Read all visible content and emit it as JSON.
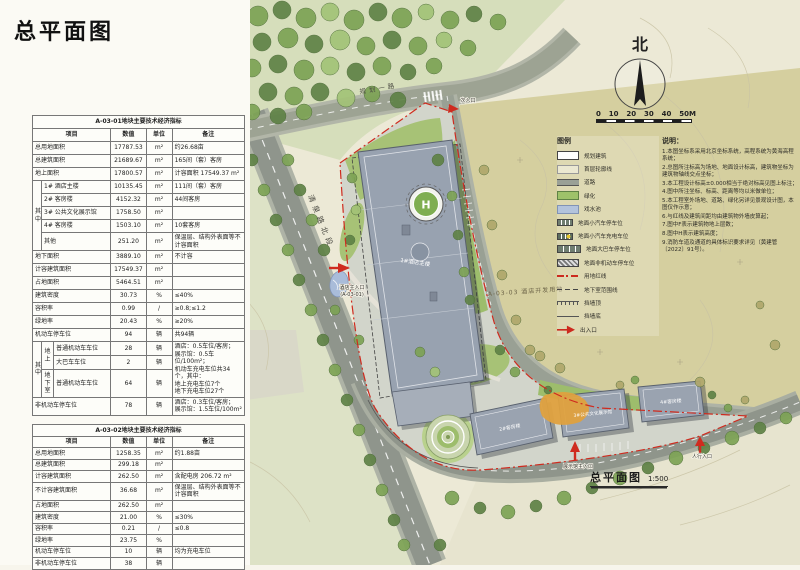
{
  "page": {
    "title": "总平面图"
  },
  "table1": {
    "title": "A-03-01地块主要技术经济指标",
    "header": [
      {
        "t": "项目",
        "cs": 3
      },
      {
        "t": "数值"
      },
      {
        "t": "单位"
      },
      {
        "t": "备注"
      }
    ],
    "rows": [
      [
        {
          "t": "总用地面积",
          "cs": 3,
          "cls": "item"
        },
        {
          "t": "17787.53",
          "cls": "num"
        },
        {
          "t": "m²",
          "cls": "unit"
        },
        {
          "t": "约26.68亩",
          "cls": "rem"
        }
      ],
      [
        {
          "t": "总建筑面积",
          "cs": 3,
          "cls": "item"
        },
        {
          "t": "21689.67",
          "cls": "num"
        },
        {
          "t": "m²",
          "cls": "unit"
        },
        {
          "t": "165间（套）客房",
          "cls": "rem"
        }
      ],
      [
        {
          "t": "地上面积",
          "cs": 3,
          "cls": "item ind1"
        },
        {
          "t": "17800.57",
          "cls": "num"
        },
        {
          "t": "m²",
          "cls": "unit"
        },
        {
          "t": "计容面积 17549.37 m²",
          "cls": "rem"
        }
      ],
      [
        {
          "t": "其中",
          "rs": 5,
          "cls": "vert"
        },
        {
          "t": "1# 酒店主楼",
          "cs": 2,
          "cls": "item ind2"
        },
        {
          "t": "10135.45",
          "cls": "num"
        },
        {
          "t": "m²",
          "cls": "unit"
        },
        {
          "t": "111间（套）客房",
          "cls": "rem"
        }
      ],
      [
        {
          "t": "2# 客房楼",
          "cs": 2,
          "cls": "item ind2"
        },
        {
          "t": "4152.32",
          "cls": "num"
        },
        {
          "t": "m²",
          "cls": "unit"
        },
        {
          "t": "44间客房",
          "cls": "rem"
        }
      ],
      [
        {
          "t": "3# 公共文化展示馆",
          "cs": 2,
          "cls": "item ind2"
        },
        {
          "t": "1758.50",
          "cls": "num"
        },
        {
          "t": "m²",
          "cls": "unit"
        },
        {
          "t": "",
          "cls": "rem"
        }
      ],
      [
        {
          "t": "4# 客房楼",
          "cs": 2,
          "cls": "item ind2"
        },
        {
          "t": "1503.10",
          "cls": "num"
        },
        {
          "t": "m²",
          "cls": "unit"
        },
        {
          "t": "10套客房",
          "cls": "rem"
        }
      ],
      [
        {
          "t": "其他",
          "cs": 2,
          "cls": "item ind2"
        },
        {
          "t": "251.20",
          "cls": "num"
        },
        {
          "t": "m²",
          "cls": "unit"
        },
        {
          "t": "保温层、结构外表面等不计容面积",
          "cls": "rem"
        }
      ],
      [
        {
          "t": "地下面积",
          "cs": 3,
          "cls": "item ind1"
        },
        {
          "t": "3889.10",
          "cls": "num"
        },
        {
          "t": "m²",
          "cls": "unit"
        },
        {
          "t": "不计容",
          "cls": "rem"
        }
      ],
      [
        {
          "t": "计容建筑面积",
          "cs": 3,
          "cls": "item"
        },
        {
          "t": "17549.37",
          "cls": "num"
        },
        {
          "t": "m²",
          "cls": "unit"
        },
        {
          "t": "",
          "cls": "rem"
        }
      ],
      [
        {
          "t": "占地面积",
          "cs": 3,
          "cls": "item ind1"
        },
        {
          "t": "5464.51",
          "cls": "num"
        },
        {
          "t": "m²",
          "cls": "unit"
        },
        {
          "t": "",
          "cls": "rem"
        }
      ],
      [
        {
          "t": "建筑密度",
          "cs": 3,
          "cls": "item ind1"
        },
        {
          "t": "30.73",
          "cls": "num"
        },
        {
          "t": "%",
          "cls": "unit"
        },
        {
          "t": "≤40%",
          "cls": "rem"
        }
      ],
      [
        {
          "t": "容积率",
          "cs": 3,
          "cls": "item ind1"
        },
        {
          "t": "0.99",
          "cls": "num"
        },
        {
          "t": "/",
          "cls": "unit"
        },
        {
          "t": "≥0.8;≤1.2",
          "cls": "rem"
        }
      ],
      [
        {
          "t": "绿地率",
          "cs": 3,
          "cls": "item ind1"
        },
        {
          "t": "20.43",
          "cls": "num"
        },
        {
          "t": "%",
          "cls": "unit"
        },
        {
          "t": "≥20%",
          "cls": "rem"
        }
      ],
      [
        {
          "t": "机动车停车位",
          "cs": 3,
          "cls": "item"
        },
        {
          "t": "94",
          "cls": "num"
        },
        {
          "t": "辆",
          "cls": "unit"
        },
        {
          "t": "共94辆",
          "cls": "rem"
        }
      ],
      [
        {
          "t": "其中",
          "rs": 3,
          "cls": "vert"
        },
        {
          "t": "地上",
          "rs": 2,
          "cls": "vert"
        },
        {
          "t": "普通机动车车位",
          "cls": "item ind2"
        },
        {
          "t": "28",
          "cls": "num"
        },
        {
          "t": "辆",
          "cls": "unit"
        },
        {
          "t": "酒店：0.5车位/客房；\n展示馆：0.5车位/100m²；\n机动车充电车位共34个，其中：\n地上充电车位7个\n地下充电车位27个",
          "rs": 3,
          "cls": "rem pre"
        }
      ],
      [
        {
          "t": "大巴车车位",
          "cls": "item ind2"
        },
        {
          "t": "2",
          "cls": "num"
        },
        {
          "t": "辆",
          "cls": "unit"
        }
      ],
      [
        {
          "t": "地下室",
          "cls": "vert"
        },
        {
          "t": "普通机动车车位",
          "cls": "item ind2"
        },
        {
          "t": "64",
          "cls": "num"
        },
        {
          "t": "辆",
          "cls": "unit"
        }
      ],
      [
        {
          "t": "非机动车停车位",
          "cs": 3,
          "cls": "item"
        },
        {
          "t": "78",
          "cls": "num"
        },
        {
          "t": "辆",
          "cls": "unit"
        },
        {
          "t": "酒店：0.3车位/客房；\n展示馆：1.5车位/100m²",
          "cls": "rem pre"
        }
      ]
    ]
  },
  "table2": {
    "title": "A-03-02地块主要技术经济指标",
    "header": [
      {
        "t": "项目"
      },
      {
        "t": "数值"
      },
      {
        "t": "单位"
      },
      {
        "t": "备注"
      }
    ],
    "rows": [
      [
        {
          "t": "总用地面积",
          "cls": "item"
        },
        {
          "t": "1258.35",
          "cls": "num"
        },
        {
          "t": "m²",
          "cls": "unit"
        },
        {
          "t": "约1.88亩",
          "cls": "rem"
        }
      ],
      [
        {
          "t": "总建筑面积",
          "cls": "item"
        },
        {
          "t": "299.18",
          "cls": "num"
        },
        {
          "t": "m²",
          "cls": "unit"
        },
        {
          "t": "",
          "cls": "rem"
        }
      ],
      [
        {
          "t": "计容建筑面积",
          "cls": "item ind1"
        },
        {
          "t": "262.50",
          "cls": "num"
        },
        {
          "t": "m²",
          "cls": "unit"
        },
        {
          "t": "含配电房 206.72 m²",
          "cls": "rem"
        }
      ],
      [
        {
          "t": "不计容建筑面积",
          "cls": "item ind1"
        },
        {
          "t": "36.68",
          "cls": "num"
        },
        {
          "t": "m²",
          "cls": "unit"
        },
        {
          "t": "保温层、结构外表面等不计容面积",
          "cls": "rem"
        }
      ],
      [
        {
          "t": "占地面积",
          "cls": "item ind1"
        },
        {
          "t": "262.50",
          "cls": "num"
        },
        {
          "t": "m²",
          "cls": "unit"
        },
        {
          "t": "",
          "cls": "rem"
        }
      ],
      [
        {
          "t": "建筑密度",
          "cls": "item ind1"
        },
        {
          "t": "21.00",
          "cls": "num"
        },
        {
          "t": "%",
          "cls": "unit"
        },
        {
          "t": "≤30%",
          "cls": "rem"
        }
      ],
      [
        {
          "t": "容积率",
          "cls": "item ind1"
        },
        {
          "t": "0.21",
          "cls": "num"
        },
        {
          "t": "/",
          "cls": "unit"
        },
        {
          "t": "≤0.8",
          "cls": "rem"
        }
      ],
      [
        {
          "t": "绿地率",
          "cls": "item ind1"
        },
        {
          "t": "23.75",
          "cls": "num"
        },
        {
          "t": "%",
          "cls": "unit"
        },
        {
          "t": "",
          "cls": "rem"
        }
      ],
      [
        {
          "t": "机动车停车位",
          "cls": "item ind1"
        },
        {
          "t": "10",
          "cls": "num"
        },
        {
          "t": "辆",
          "cls": "unit"
        },
        {
          "t": "均为充电车位",
          "cls": "rem"
        }
      ],
      [
        {
          "t": "非机动车停车位",
          "cls": "item ind1"
        },
        {
          "t": "38",
          "cls": "num"
        },
        {
          "t": "辆",
          "cls": "unit"
        },
        {
          "t": "",
          "cls": "rem"
        }
      ]
    ]
  },
  "legend": {
    "title": "图例",
    "items": [
      {
        "label": "规划建筑",
        "swatch": "building"
      },
      {
        "label": "首层轮廓线",
        "swatch": "outline"
      },
      {
        "label": "道路",
        "swatch": "road"
      },
      {
        "label": "绿化",
        "swatch": "green"
      },
      {
        "label": "戏水池",
        "swatch": "water"
      },
      {
        "label": "地面小汽车停车位",
        "swatch": "park"
      },
      {
        "label": "地面小汽车充电车位",
        "swatch": "charge"
      },
      {
        "label": "地面大巴车停车位",
        "swatch": "bus"
      },
      {
        "label": "地面非机动车停车位",
        "swatch": "nonmotor"
      },
      {
        "label": "用地红线",
        "swatch": "redline"
      },
      {
        "label": "地下室范围线",
        "swatch": "basement"
      },
      {
        "label": "挡墙顶",
        "swatch": "walltop"
      },
      {
        "label": "挡墙底",
        "swatch": "wallbase"
      },
      {
        "label": "出入口",
        "swatch": "entry"
      }
    ]
  },
  "notes": {
    "title": "说明：",
    "lines": [
      "1.本图坐标系采用北京坐标系统，高程系统为黄海高程系统；",
      "2.总图所注标高为场地、地面设计标高，建筑物坐标为建筑物轴线交点坐标；",
      "3.本工程设计标高±0.000相当于绝对标高见图上标注；",
      "4.图中所注坐标、标高、距离等均以米做单位；",
      "5.本工程室外场地、道路、绿化另详见景观设计图，本图仅作示意；",
      "6.与红线及建筑间距均由建筑物外墙皮算起；",
      "7.图中F表示建筑物地上层数；",
      "8.图中H表示建筑高度；",
      "9.消防车道及通道的具体标识要求详见（黄建管〔2022〕91号）。"
    ]
  },
  "map": {
    "north_label": "北",
    "scale_ticks": [
      "0",
      "10",
      "20",
      "30",
      "40",
      "50M"
    ],
    "plan_title": "总平面图",
    "plan_scale": "1:500",
    "roads": {
      "west": "清泉路北段",
      "north": "规划一路"
    },
    "parcel_east": "A-03-03 酒店开发用地",
    "buildings": {
      "b1": "1#酒店主楼",
      "b2": "2#客房楼",
      "b3": "3#公共文化展示馆",
      "b4": "4#客房楼"
    },
    "helipad_mark": "H",
    "entrances": {
      "main": "酒店主入口",
      "main_tag": "(A-03-01)",
      "exhibit": "展示馆主入口",
      "side": "次入口",
      "ped": "人行入口"
    }
  }
}
